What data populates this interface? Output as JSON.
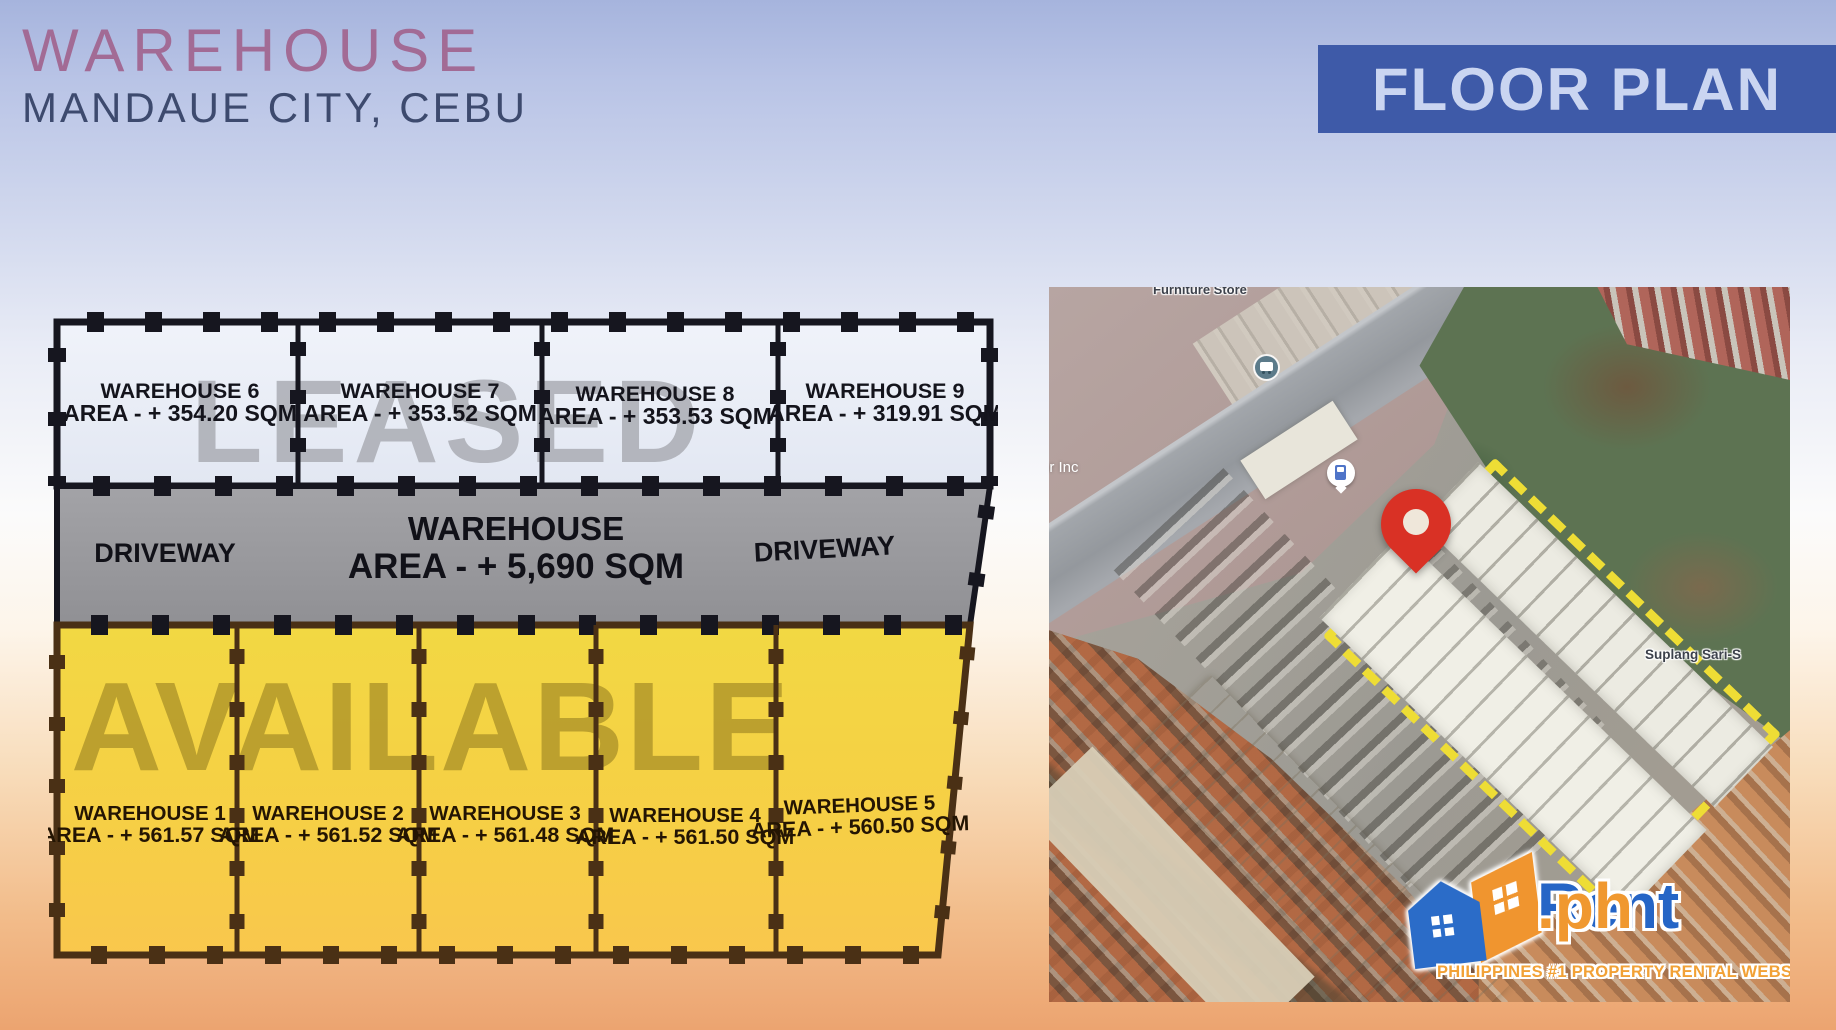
{
  "header": {
    "title": "WAREHOUSE",
    "subtitle": "MANDAUE CITY, CEBU",
    "banner": "FLOOR PLAN"
  },
  "floorplan": {
    "leased_watermark": "LEASED",
    "available_watermark": "AVAILABLE",
    "driveway_left": "DRIVEWAY",
    "driveway_right": "DRIVEWAY",
    "main_unit": {
      "name": "WAREHOUSE",
      "area": "AREA - + 5,690 SQM"
    },
    "leased_units": [
      {
        "name": "WAREHOUSE 6",
        "area": "AREA - + 354.20 SQM"
      },
      {
        "name": "WAREHOUSE 7",
        "area": "AREA - + 353.52 SQM"
      },
      {
        "name": "WAREHOUSE 8",
        "area": "AREA - + 353.53 SQM"
      },
      {
        "name": "WAREHOUSE 9",
        "area": "AREA - + 319.91 SQM"
      }
    ],
    "available_units": [
      {
        "name": "WAREHOUSE 1",
        "area": "AREA - + 561.57 SQM"
      },
      {
        "name": "WAREHOUSE 2",
        "area": "AREA - + 561.52 SQM"
      },
      {
        "name": "WAREHOUSE 3",
        "area": "AREA - + 561.48 SQM"
      },
      {
        "name": "WAREHOUSE 4",
        "area": "AREA - + 561.50 SQM"
      },
      {
        "name": "WAREHOUSE 5",
        "area": "AREA - + 560.50 SQM"
      }
    ]
  },
  "map": {
    "labels": {
      "furniture_store": "Furniture Store",
      "inc": "or Inc",
      "sari": "Suplang Sari-S"
    }
  },
  "logo": {
    "brand_primary": "Rent",
    "brand_suffix": ".ph",
    "tagline": "PHILIPPINES #1 PROPERTY RENTAL WEBSITE"
  },
  "colors": {
    "banner_bg": "#3e5aa8",
    "title_mauve": "#a26b95",
    "subtitle_navy": "#3d4a6e",
    "available_yellow": "#f5cf45",
    "leased_gray": "#9e9ea2",
    "boundary_yellow": "#eedd35",
    "pin_red": "#d93125",
    "brand_blue": "#2565c6",
    "brand_orange": "#f0982f"
  }
}
